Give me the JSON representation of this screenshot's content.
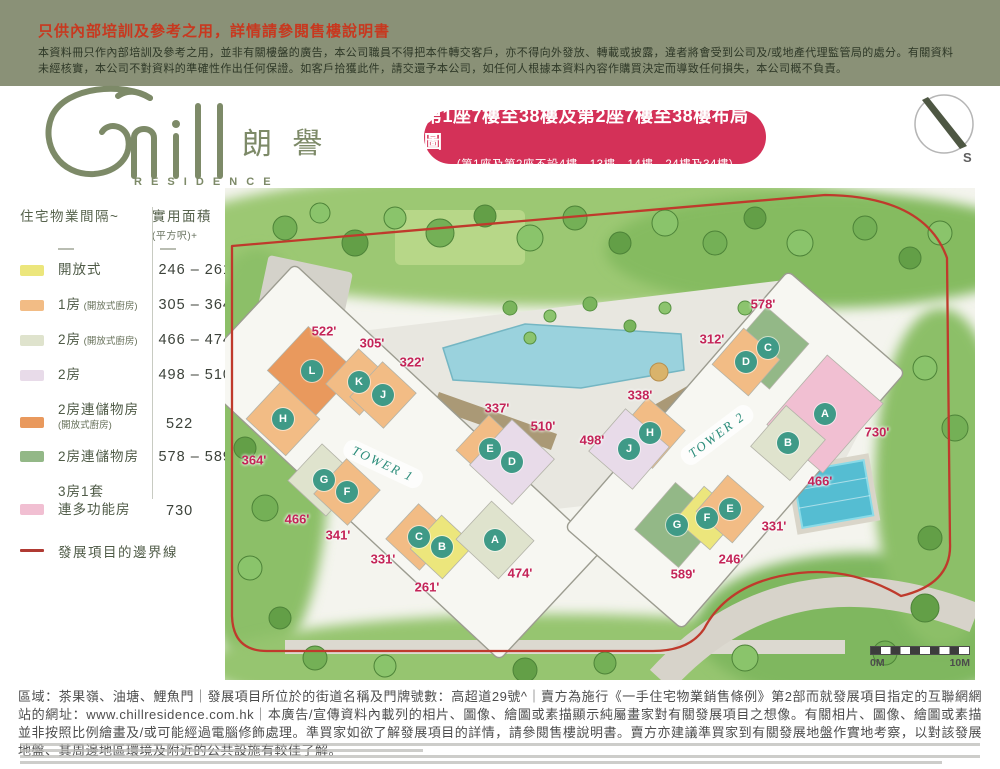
{
  "colors": {
    "banner_bg": "#8a9177",
    "banner_heading": "#c8381f",
    "brand_green": "#7d8a68",
    "title_box_bg": "#d43158",
    "area_label": "#c42458",
    "badge_bg": "#3f9a87",
    "tower_label": "#2c8d7b",
    "boundary_red": "#bf3a2c",
    "unit_types": {
      "open": "#ece67c",
      "one_bed": "#f2bc85",
      "two_bed_open": "#dfe3cd",
      "two_bed": "#e8dbe9",
      "two_bed_store_open": "#e9995d",
      "two_bed_store": "#93b887",
      "three_bed": "#f1bfd2"
    }
  },
  "banner": {
    "heading": "只供內部培訓及參考之用，詳情請參閱售樓說明書",
    "body": "本資料冊只作內部培訓及參考之用，並非有關樓盤的廣告，本公司職員不得把本件轉交客戶，亦不得向外發放、轉載或披露，違者將會受到公司及/或地產代理監管局的處分。有關資料未經核實，本公司不對資料的準確性作出任何保證。如客戶拾獲此件，請交還予本公司，如任何人根據本資料內容作購買決定而導致任何損失，本公司概不負責。"
  },
  "logo": {
    "name_script": "Chill",
    "name_cjk": "朗 譽",
    "name_en": "R E S I D E N C E"
  },
  "title_box": {
    "line1": "第1座7樓至38樓及第2座7樓至38樓布局圖",
    "line2": "(第1座及第2座不設4樓、13樓、14樓、24樓及34樓)"
  },
  "compass": {
    "label": "S"
  },
  "legend": {
    "col1_header": "住宅物業間隔~",
    "col2_header": "實用面積",
    "col2_subheader": "(平方呎)+",
    "rows": [
      {
        "label": "開放式",
        "type": "open",
        "value": "246 – 261"
      },
      {
        "label": "1房",
        "sub": "(開放式廚房)",
        "type": "one_bed",
        "value": "305 – 364"
      },
      {
        "label": "2房",
        "sub": "(開放式廚房)",
        "type": "two_bed_open",
        "value": "466 – 474"
      },
      {
        "label": "2房",
        "type": "two_bed",
        "value": "498 – 510"
      },
      {
        "label": "2房連儲物房",
        "sub2": "(開放式廚房)",
        "type": "two_bed_store_open",
        "value": "522"
      },
      {
        "label": "2房連儲物房",
        "type": "two_bed_store",
        "value": "578 – 589"
      },
      {
        "label": "3房1套",
        "label2": "連多功能房",
        "type": "three_bed",
        "value": "730"
      }
    ],
    "boundary_label": "發展項目的邊界線"
  },
  "map": {
    "towers": [
      {
        "name": "TOWER 1",
        "angle": 43,
        "cx": 172,
        "cy": 274,
        "len": 420,
        "wid": 150,
        "label_x": 158,
        "label_y": 276,
        "label_angle": 25,
        "units": [
          {
            "letter": "L",
            "type": "two_bed_store_open",
            "x": 87,
            "y": 183,
            "w": 66,
            "h": 60
          },
          {
            "letter": "K",
            "type": "one_bed",
            "x": 134,
            "y": 194,
            "w": 46,
            "h": 48
          },
          {
            "letter": "J",
            "type": "one_bed",
            "x": 158,
            "y": 207,
            "w": 46,
            "h": 48
          },
          {
            "letter": "H",
            "type": "one_bed",
            "x": 58,
            "y": 231,
            "w": 54,
            "h": 50
          },
          {
            "letter": "G",
            "type": "two_bed_open",
            "x": 99,
            "y": 292,
            "w": 52,
            "h": 50
          },
          {
            "letter": "F",
            "type": "one_bed",
            "x": 122,
            "y": 304,
            "w": 46,
            "h": 48
          },
          {
            "letter": "E",
            "type": "one_bed",
            "x": 265,
            "y": 261,
            "w": 48,
            "h": 48
          },
          {
            "letter": "D",
            "type": "two_bed",
            "x": 287,
            "y": 274,
            "w": 58,
            "h": 62
          },
          {
            "letter": "C",
            "type": "one_bed",
            "x": 194,
            "y": 349,
            "w": 46,
            "h": 48
          },
          {
            "letter": "B",
            "type": "open",
            "x": 217,
            "y": 359,
            "w": 44,
            "h": 46
          },
          {
            "letter": "A",
            "type": "two_bed_open",
            "x": 270,
            "y": 352,
            "w": 58,
            "h": 52
          }
        ],
        "areas": [
          {
            "text": "522'",
            "x": 99,
            "y": 143
          },
          {
            "text": "305'",
            "x": 147,
            "y": 155
          },
          {
            "text": "322'",
            "x": 187,
            "y": 174
          },
          {
            "text": "337'",
            "x": 272,
            "y": 220
          },
          {
            "text": "510'",
            "x": 318,
            "y": 238
          },
          {
            "text": "364'",
            "x": 29,
            "y": 272
          },
          {
            "text": "466'",
            "x": 72,
            "y": 331
          },
          {
            "text": "341'",
            "x": 113,
            "y": 347
          },
          {
            "text": "331'",
            "x": 158,
            "y": 371
          },
          {
            "text": "261'",
            "x": 202,
            "y": 399
          },
          {
            "text": "474'",
            "x": 295,
            "y": 385
          }
        ]
      },
      {
        "name": "TOWER 2",
        "angle": -49,
        "cx": 510,
        "cy": 262,
        "len": 340,
        "wid": 155,
        "label_x": 492,
        "label_y": 247,
        "label_angle": -37,
        "units": [
          {
            "letter": "C",
            "type": "two_bed_store",
            "x": 543,
            "y": 160,
            "w": 60,
            "h": 56
          },
          {
            "letter": "D",
            "type": "one_bed",
            "x": 521,
            "y": 174,
            "w": 48,
            "h": 48
          },
          {
            "letter": "A",
            "type": "three_bed",
            "x": 600,
            "y": 226,
            "w": 92,
            "h": 74
          },
          {
            "letter": "H",
            "type": "one_bed",
            "x": 425,
            "y": 245,
            "w": 50,
            "h": 50
          },
          {
            "letter": "J",
            "type": "two_bed",
            "x": 404,
            "y": 261,
            "w": 56,
            "h": 58
          },
          {
            "letter": "B",
            "type": "two_bed_open",
            "x": 563,
            "y": 255,
            "w": 54,
            "h": 52
          },
          {
            "letter": "G",
            "type": "two_bed_store",
            "x": 452,
            "y": 337,
            "w": 62,
            "h": 58
          },
          {
            "letter": "F",
            "type": "open",
            "x": 482,
            "y": 330,
            "w": 44,
            "h": 46
          },
          {
            "letter": "E",
            "type": "one_bed",
            "x": 505,
            "y": 321,
            "w": 48,
            "h": 48
          }
        ],
        "areas": [
          {
            "text": "578'",
            "x": 538,
            "y": 116
          },
          {
            "text": "312'",
            "x": 487,
            "y": 151
          },
          {
            "text": "338'",
            "x": 415,
            "y": 207
          },
          {
            "text": "498'",
            "x": 367,
            "y": 252
          },
          {
            "text": "730'",
            "x": 652,
            "y": 244
          },
          {
            "text": "466'",
            "x": 595,
            "y": 293
          },
          {
            "text": "331'",
            "x": 549,
            "y": 338
          },
          {
            "text": "246'",
            "x": 506,
            "y": 371
          },
          {
            "text": "589'",
            "x": 458,
            "y": 386
          }
        ]
      }
    ],
    "scale": {
      "left": "0M",
      "right": "10M"
    }
  },
  "footer": {
    "body": "區域：茶果嶺、油塘、鯉魚門｜發展項目所位於的街道名稱及門牌號數：高超道29號^｜賣方為施行《一手住宅物業銷售條例》第2部而就發展項目指定的互聯網網站的網址：www.chillresidence.com.hk｜本廣告/宣傳資料內載列的相片、圖像、繪圖或素描顯示純屬畫家對有關發展項目之想像。有關相片、圖像、繪圖或素描並非按照比例繪畫及/或可能經過電腦修飾處理。準買家如欲了解發展項目的詳情，請參閱售樓說明書。賣方亦建議準買家到有關發展地盤作實地考察，以對該發展地盤、其周邊地區環境及附近的公共設施有較佳了解。"
  }
}
